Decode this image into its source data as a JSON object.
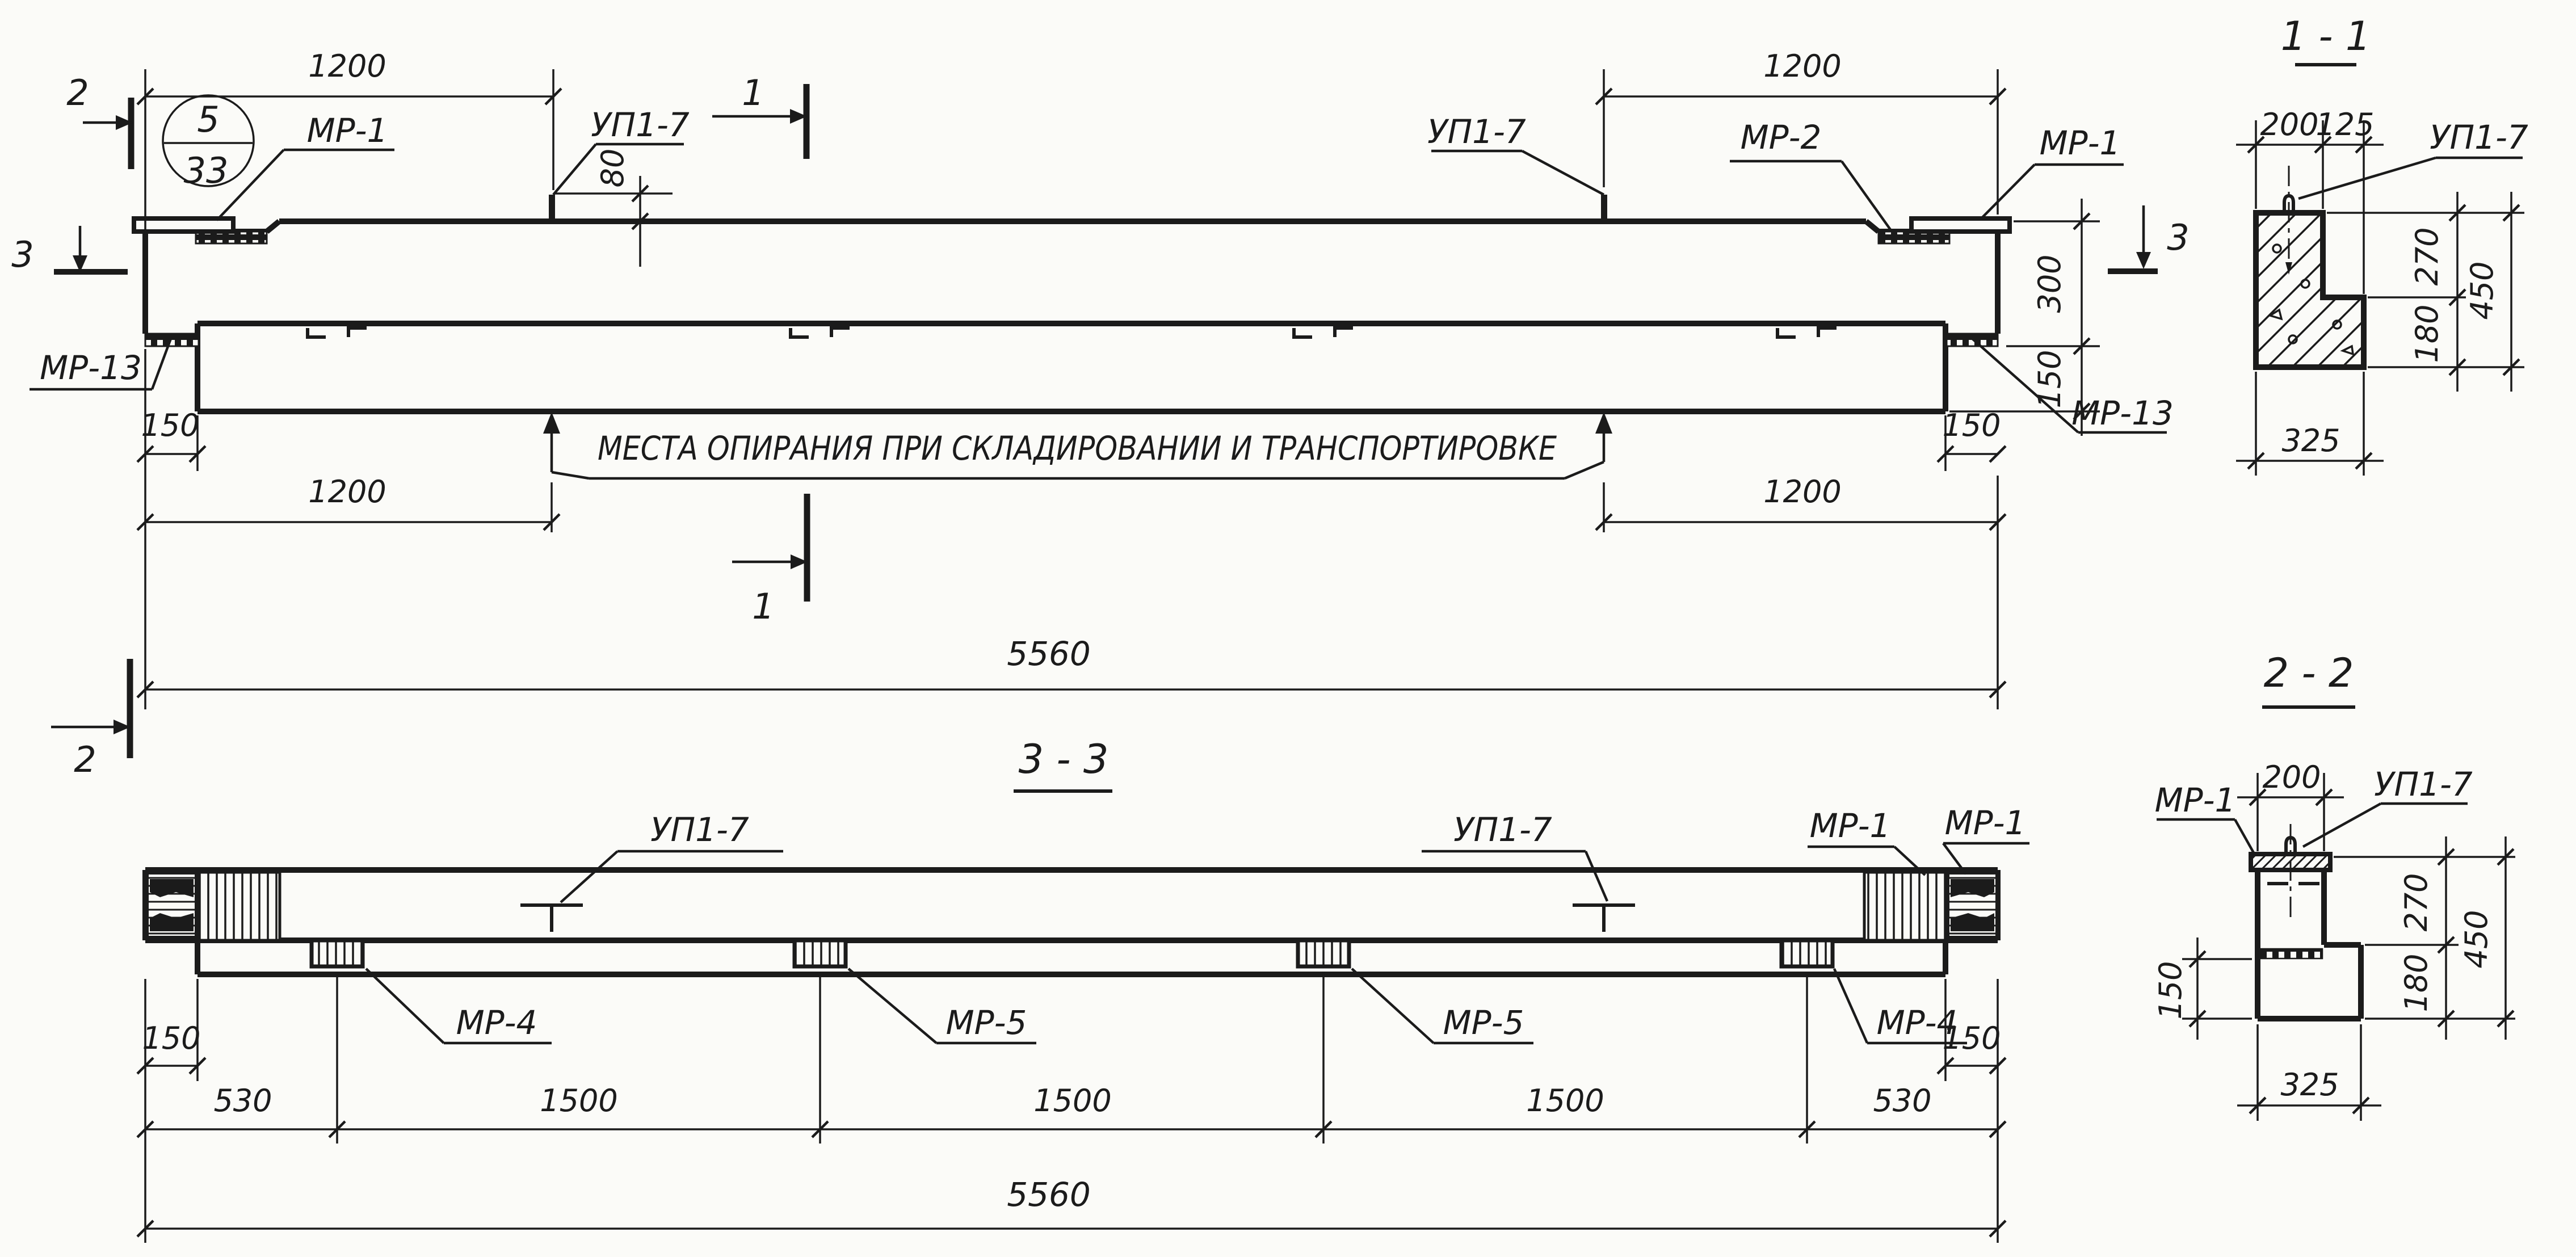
{
  "colors": {
    "ink": "#1b1b1b",
    "paper": "#fbfbf8"
  },
  "note": "МЕСТА ОПИРАНИЯ ПРИ СКЛАДИРОВАНИИ И ТРАНСПОРТИРОВКЕ",
  "mark": {
    "top": "5",
    "bottom": "33"
  },
  "sections": {
    "s11": "1 - 1",
    "s22": "2 - 2",
    "s33": "3 - 3"
  },
  "markers": {
    "m1": "1",
    "m2": "2",
    "m3": "3"
  },
  "labels": {
    "mr1": "МР-1",
    "mr2": "МР-2",
    "mr4": "МР-4",
    "mr5": "МР-5",
    "mr13": "МР-13",
    "up17": "УП1-7"
  },
  "dims": {
    "d80": "80",
    "d125": "125",
    "d150": "150",
    "d180": "180",
    "d200": "200",
    "d270": "270",
    "d300": "300",
    "d325": "325",
    "d450": "450",
    "d530": "530",
    "d1200": "1200",
    "d1500": "1500",
    "d5560": "5560"
  }
}
